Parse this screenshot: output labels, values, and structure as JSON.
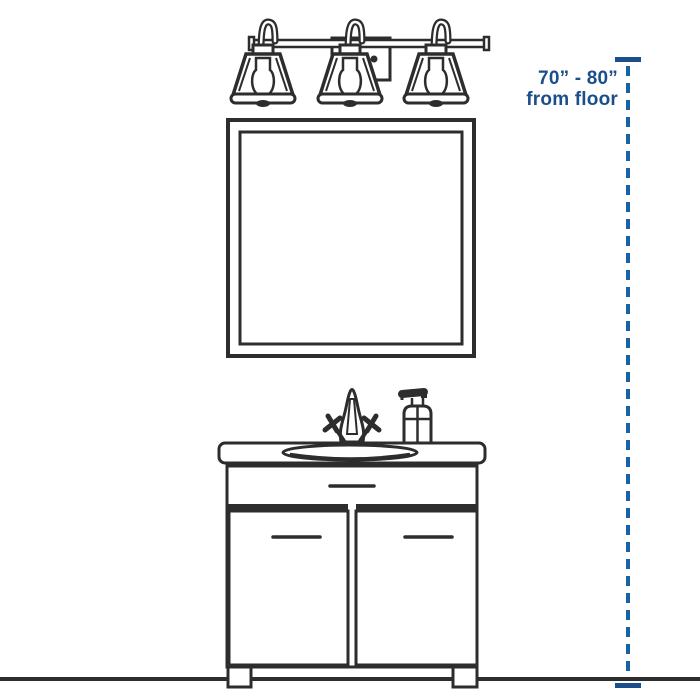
{
  "annotation": {
    "range_label": "70” - 80”",
    "from_label": "from floor"
  },
  "figure_components": [
    "three-light-vanity-fixture-icon",
    "mirror-icon",
    "vanity-cabinet-icon",
    "sink-basin-icon",
    "faucet-icon",
    "soap-dispenser-icon",
    "floor-line",
    "height-dimension-dashed-line"
  ],
  "colors": {
    "line": "#2d2d2d",
    "text_blue": "#1b4e8a",
    "dash_blue": "#1a62a6"
  }
}
